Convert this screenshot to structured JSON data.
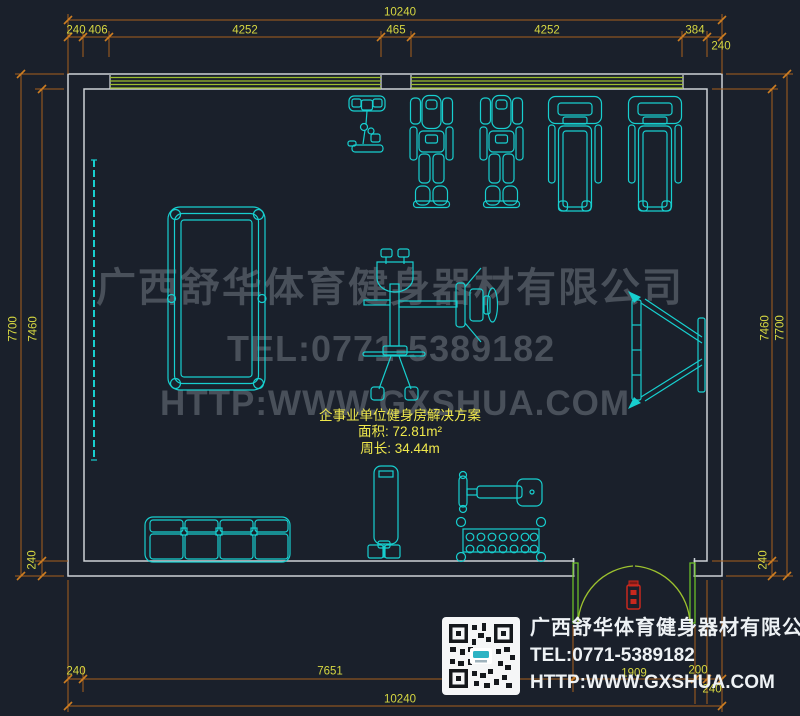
{
  "colors": {
    "background": "#1a202b",
    "wall": "#ccd1d6",
    "equipment_cyan": "#17cfcf",
    "window_green": "#9dbe2d",
    "door_green": "#6abe28",
    "door_symbol_red": "#c8281e",
    "dimension_line": "#a8611c",
    "dimension_text": "#d6d741",
    "label_yellow": "#efe84c",
    "watermark_gray": "#49505a",
    "footer_white": "#eef2f5"
  },
  "watermark": {
    "company": "广西舒华体育健身器材有限公司",
    "tel": "TEL:0771-5389182",
    "url": "HTTP:WWW.GXSHUA.COM"
  },
  "room_label": {
    "title": "企事业单位健身房解决方案",
    "area": "面积: 72.81m²",
    "perimeter": "周长: 34.44m"
  },
  "footer": {
    "company": "广西舒华体育健身器材有限公司",
    "tel": "TEL:0771-5389182",
    "url": "HTTP:WWW.GXSHUA.COM"
  },
  "dimensions": {
    "top_total": "10240",
    "top_240": "240",
    "top_406": "406",
    "top_4252_left": "4252",
    "top_465": "465",
    "top_4252_right": "4252",
    "top_384": "384",
    "top_right_240": "240",
    "left_7700": "7700",
    "left_7460": "7460",
    "left_240": "240",
    "right_7460": "7460",
    "right_7700": "7700",
    "right_240": "240",
    "bottom_240": "240",
    "bottom_7651": "7651",
    "bottom_1909": "1909",
    "bottom_200": "200",
    "bottom_wall_240": "240",
    "bottom_total": "10240"
  },
  "equipment": [
    "exercise-bike",
    "massage-chair",
    "massage-chair",
    "treadmill",
    "treadmill",
    "billiard-table",
    "multi-station-gym",
    "wall-mirror",
    "sit-up-board",
    "sofa-four-seat",
    "heavy-bag-stand",
    "flat-bench",
    "dumbbell-rack",
    "double-door",
    "qr-code"
  ]
}
